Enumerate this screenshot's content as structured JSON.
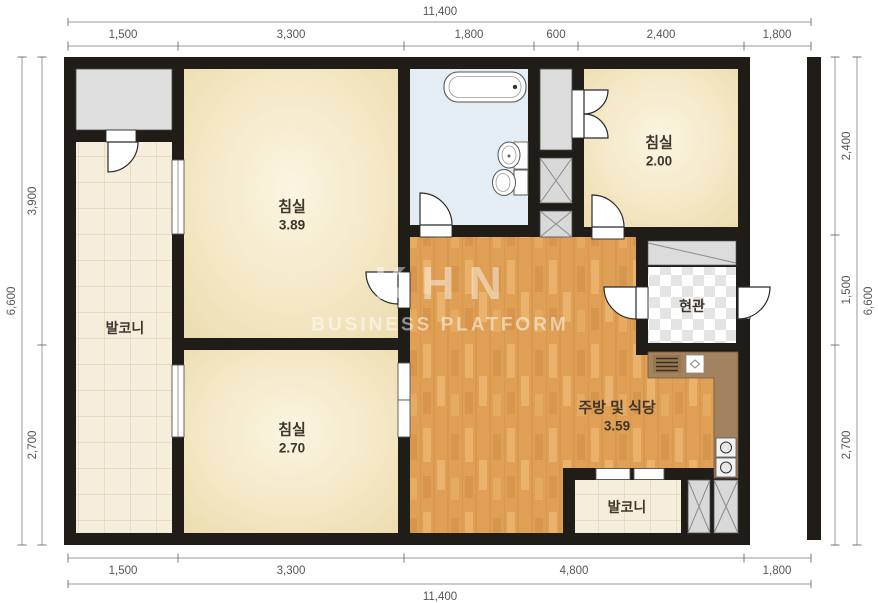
{
  "watermark": {
    "logo": "KHN",
    "subtitle": "BUSINESS PLATFORM"
  },
  "rooms": {
    "bedroom_large": {
      "name": "침실",
      "area": "3.89"
    },
    "bedroom_small": {
      "name": "침실",
      "area": "2.00"
    },
    "bedroom_bottom": {
      "name": "침실",
      "area": "2.70"
    },
    "kitchen_dining": {
      "name": "주방 및 식당",
      "area": "3.59"
    },
    "entrance": {
      "name": "현관"
    },
    "balcony_left": {
      "name": "발코니"
    },
    "balcony_bottom": {
      "name": "발코니"
    }
  },
  "dimensions": {
    "top": {
      "total": "11,400",
      "segments": [
        "1,500",
        "3,300",
        "1,800",
        "600",
        "2,400",
        "1,800"
      ]
    },
    "bottom": {
      "total": "11,400",
      "segments": [
        "1,500",
        "3,300",
        "4,800",
        "1,800"
      ]
    },
    "left": {
      "total": "6,600",
      "segments": [
        "3,900",
        "2,700"
      ]
    },
    "right": {
      "total": "6,600",
      "segments": [
        "2,400",
        "1,500",
        "2,700"
      ]
    }
  },
  "colors": {
    "wall": "#201d19",
    "bathroom_floor": "#e3edf3",
    "counter": "#a3835f",
    "shaft_gray": "#d9d9d9",
    "storage_gray": "#dfdfdf",
    "cabinet_gray": "#dcdcdc"
  }
}
